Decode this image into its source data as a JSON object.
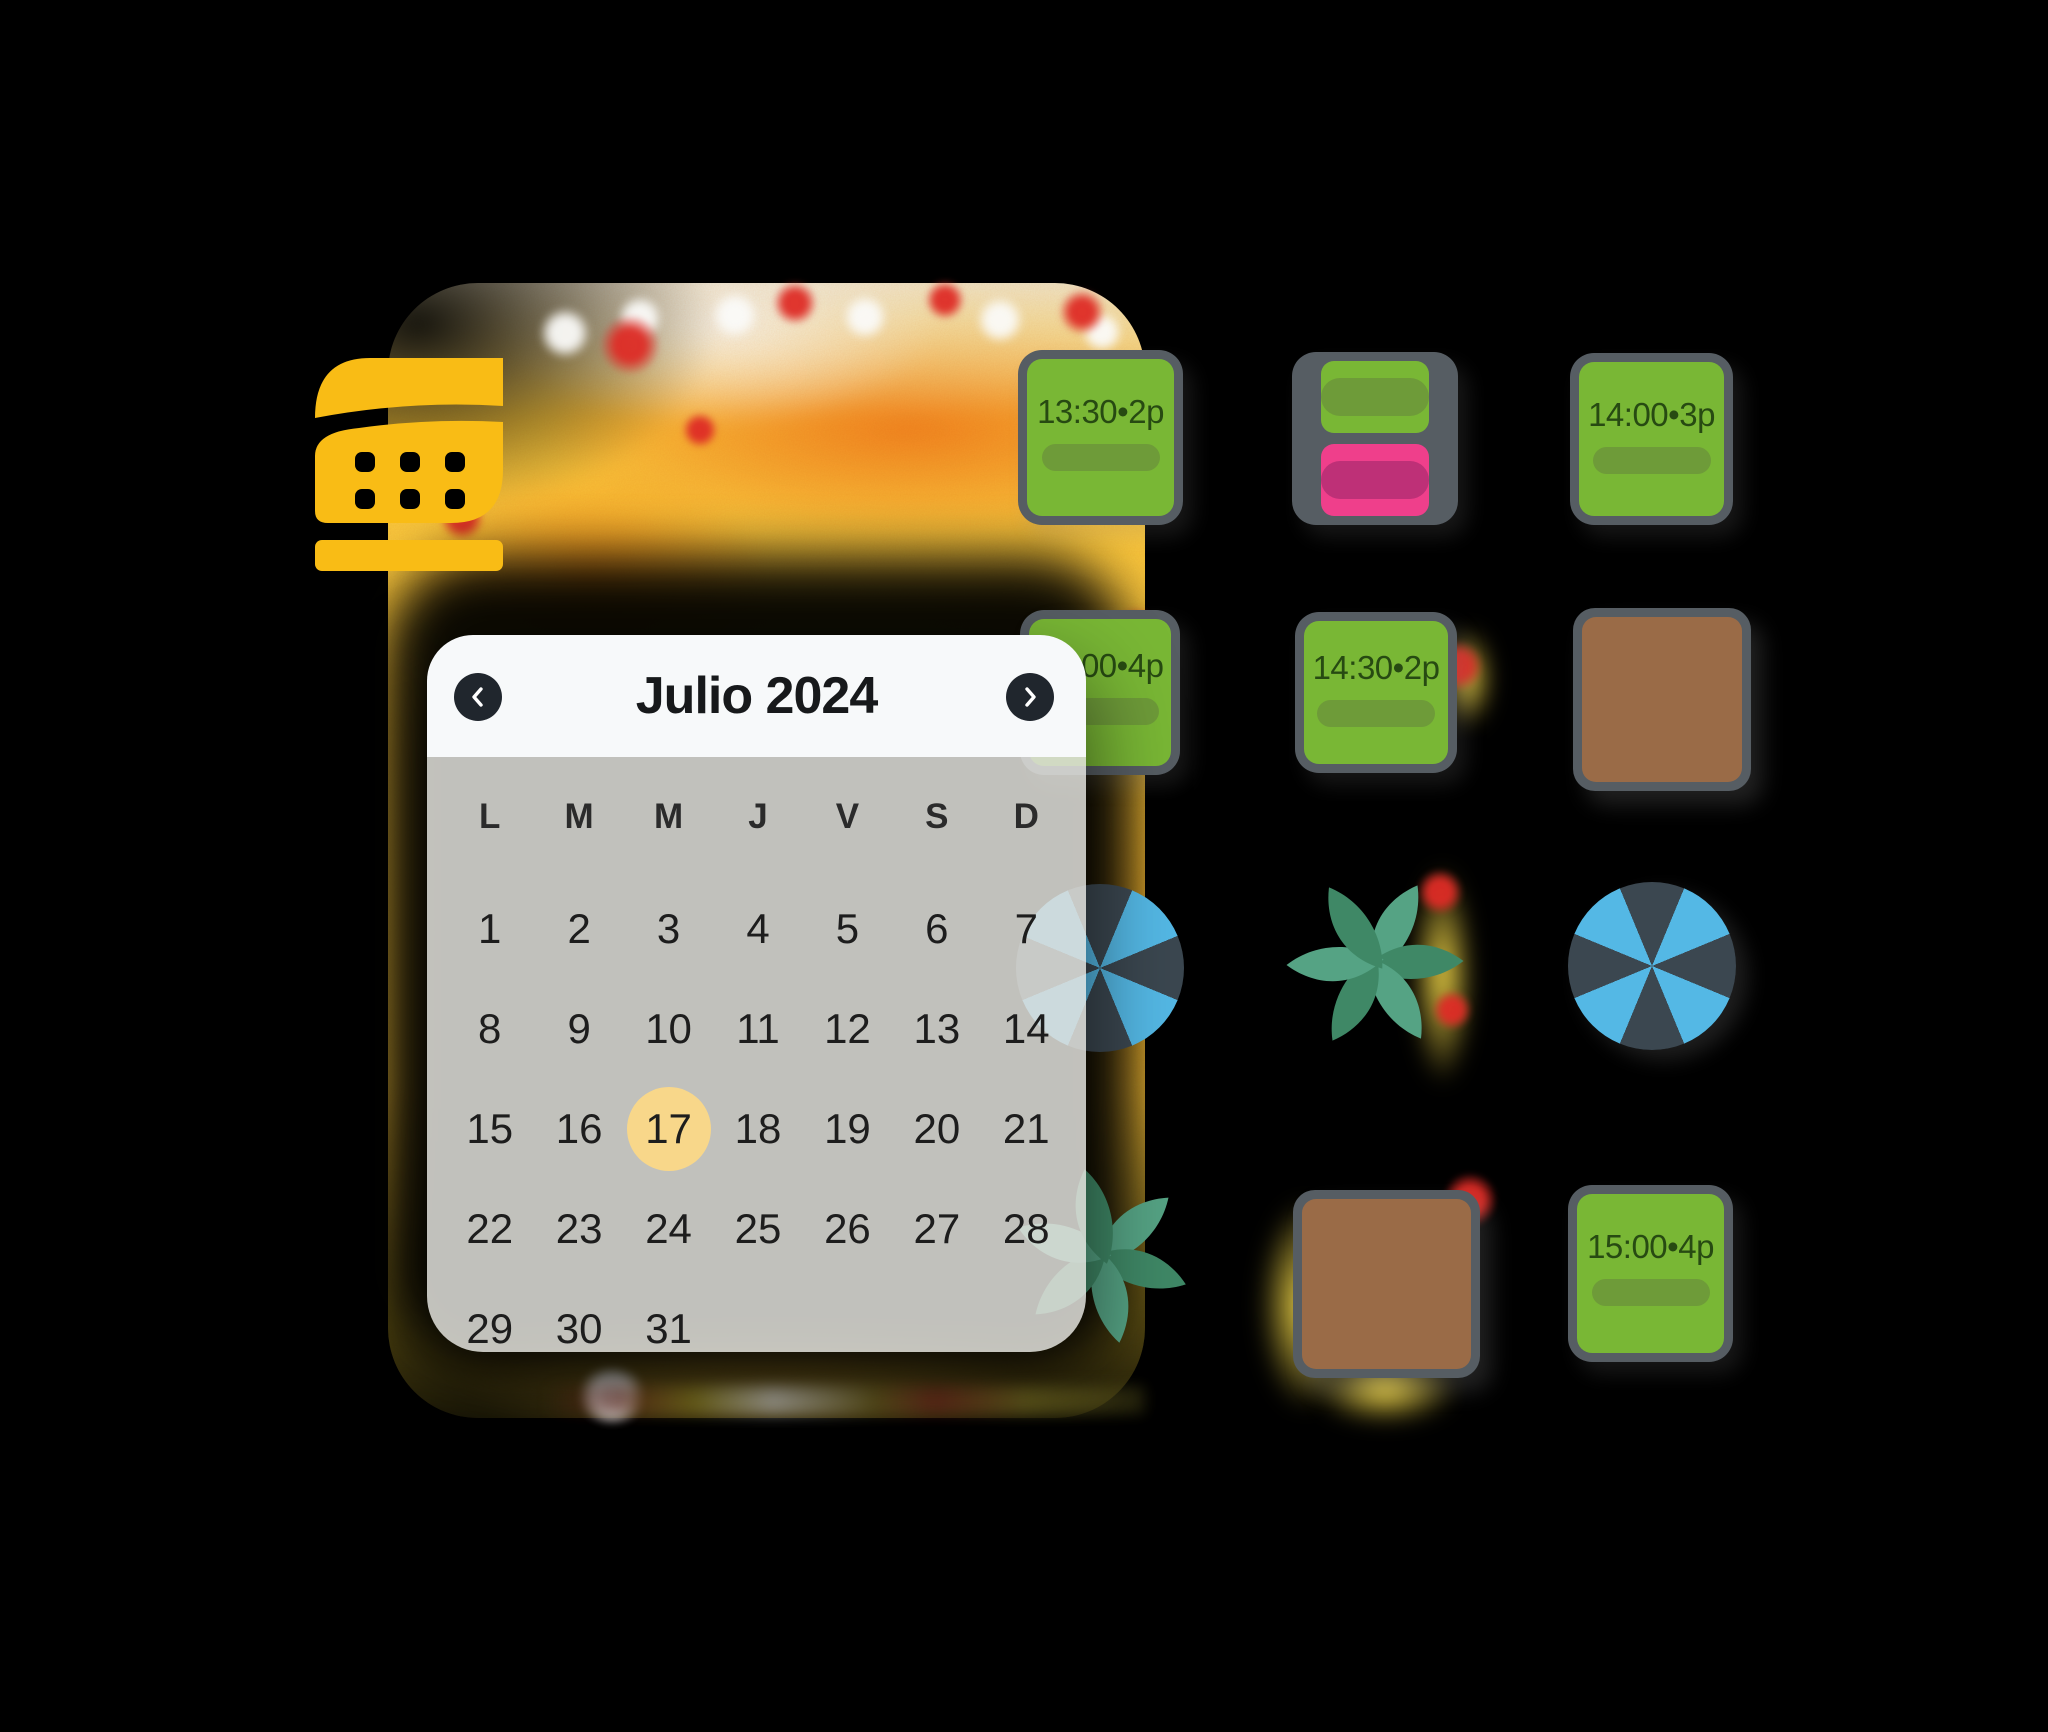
{
  "app": {
    "background": "#000000"
  },
  "logo": {
    "icon": "covermanager-logo",
    "color": "#F9BC15"
  },
  "calendar": {
    "title": "Julio 2024",
    "day_headers": [
      "L",
      "M",
      "M",
      "J",
      "V",
      "S",
      "D"
    ],
    "days": [
      "1",
      "2",
      "3",
      "4",
      "5",
      "6",
      "7",
      "8",
      "9",
      "10",
      "11",
      "12",
      "13",
      "14",
      "15",
      "16",
      "17",
      "18",
      "19",
      "20",
      "21",
      "22",
      "23",
      "24",
      "25",
      "26",
      "27",
      "28",
      "29",
      "30",
      "31",
      "",
      "",
      "",
      ""
    ],
    "selected_day": "17",
    "colors": {
      "header_bg": "#F7F9FA",
      "body_bg": "rgba(224,223,219,0.86)",
      "selected_circle": "#F8D78A",
      "nav_button": "#20262D",
      "title_text": "#17191B",
      "day_text": "#1D1D1D"
    }
  },
  "reservations": [
    {
      "label": "13:30•2p",
      "status": "booked-green"
    },
    {
      "label": "",
      "status": "split-green-pink"
    },
    {
      "label": "14:00•3p",
      "status": "booked-green"
    },
    {
      "label": "14:00•4p",
      "status": "booked-green"
    },
    {
      "label": "14:30•2p",
      "status": "booked-green"
    },
    {
      "label": "15:00•4p",
      "status": "booked-green"
    }
  ],
  "scene": {
    "card_green": "#79B735",
    "card_pill_green": "#6E9B39",
    "card_pink": "#EF3F8B",
    "card_pill_pink": "#BE3077",
    "card_border": "#565D63",
    "card_text": "#274A12",
    "table_brown": "#9A6B47",
    "umbrella_light": "#54B8E5",
    "umbrella_dark": "#3B4750",
    "plant_light": "#55A384",
    "plant_dark": "#3F8866"
  }
}
